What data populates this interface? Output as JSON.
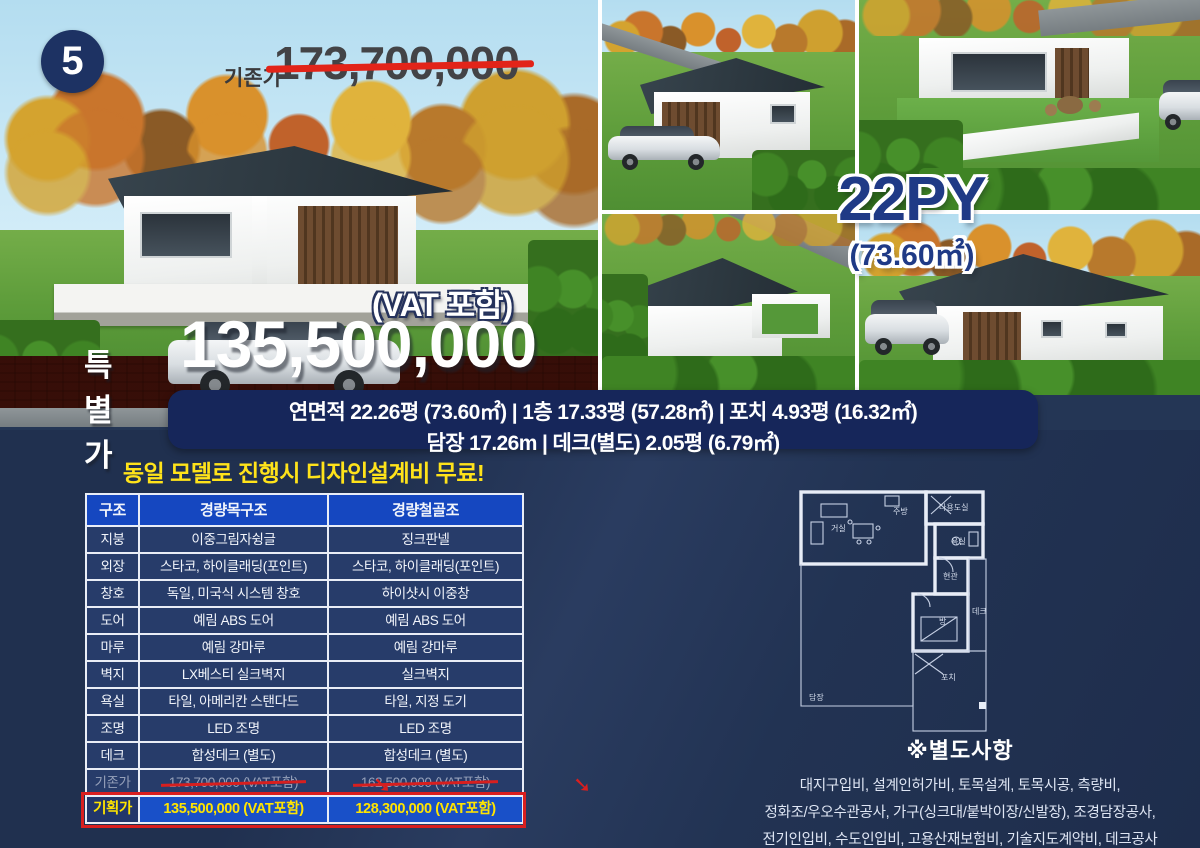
{
  "badge": {
    "number": "5"
  },
  "hero": {
    "old_price_label": "기존가",
    "old_price": "173,700,000",
    "vat_note": "(VAT 포함)",
    "special_price_label": "특별가",
    "special_price": "135,500,000"
  },
  "size_badge": {
    "py": "22PY",
    "area": "(73.60㎡)"
  },
  "spec_banner": {
    "line1": "연면적 22.26평 (73.60㎡) | 1층 17.33평 (57.28㎡) | 포치 4.93평 (16.32㎡)",
    "line2": "담장 17.26m | 데크(별도) 2.05평 (6.79㎡)"
  },
  "promo": {
    "text": "동일 모델로 진행시 디자인설계비 무료!"
  },
  "spec_table": {
    "headers": {
      "c0": "구조",
      "c1": "경량목구조",
      "c2": "경량철골조"
    },
    "rows": [
      {
        "c0": "지붕",
        "c1": "이중그림자슁글",
        "c2": "징크판넬"
      },
      {
        "c0": "외장",
        "c1": "스타코, 하이클래딩(포인트)",
        "c2": "스타코, 하이클래딩(포인트)"
      },
      {
        "c0": "창호",
        "c1": "독일, 미국식 시스템 창호",
        "c2": "하이샷시 이중창"
      },
      {
        "c0": "도어",
        "c1": "예림 ABS 도어",
        "c2": "예림 ABS 도어"
      },
      {
        "c0": "마루",
        "c1": "예림 강마루",
        "c2": "예림 강마루"
      },
      {
        "c0": "벽지",
        "c1": "LX베스티 실크벽지",
        "c2": "실크벽지"
      },
      {
        "c0": "욕실",
        "c1": "타일, 아메리칸 스탠다드",
        "c2": "타일, 지정 도기"
      },
      {
        "c0": "조명",
        "c1": "LED 조명",
        "c2": "LED 조명"
      },
      {
        "c0": "데크",
        "c1": "합성데크 (별도)",
        "c2": "합성데크 (별도)"
      }
    ],
    "old_price_row": {
      "c0": "기존가",
      "c1": "173,700,000 (VAT포함)",
      "c2": "162,500,000 (VAT포함)"
    },
    "plan_price_row": {
      "c0": "기획가",
      "c1": "135,500,000 (VAT포함)",
      "c2": "128,300,000 (VAT포함)"
    },
    "arrow_glyph": "➘"
  },
  "floor_plan": {
    "labels": {
      "living": "거실",
      "kitchen": "주방",
      "utility": "다용도실",
      "bath": "욕실",
      "entrance": "현관",
      "room": "방",
      "deck": "데크",
      "porch": "포치",
      "fence": "담장"
    }
  },
  "extras": {
    "title": "※별도사항",
    "lines": [
      "대지구입비, 설계인허가비, 토목설계, 토목시공, 측량비,",
      "정화조/우오수관공사, 가구(싱크대/붙박이장/신발장), 조경담장공사,",
      "전기인입비, 수도인입비, 고용산재보험비, 기술지도계약비, 데크공사"
    ]
  },
  "colors": {
    "background_navy": "#243655",
    "banner_navy": "#16265a",
    "table_header_blue": "#1547c0",
    "plan_row_blue": "#1950c8",
    "highlight_yellow": "#ffe400",
    "strike_red": "#d91f1f",
    "badge_navy": "#1d3263",
    "size_text_navy": "#1f3a86"
  }
}
